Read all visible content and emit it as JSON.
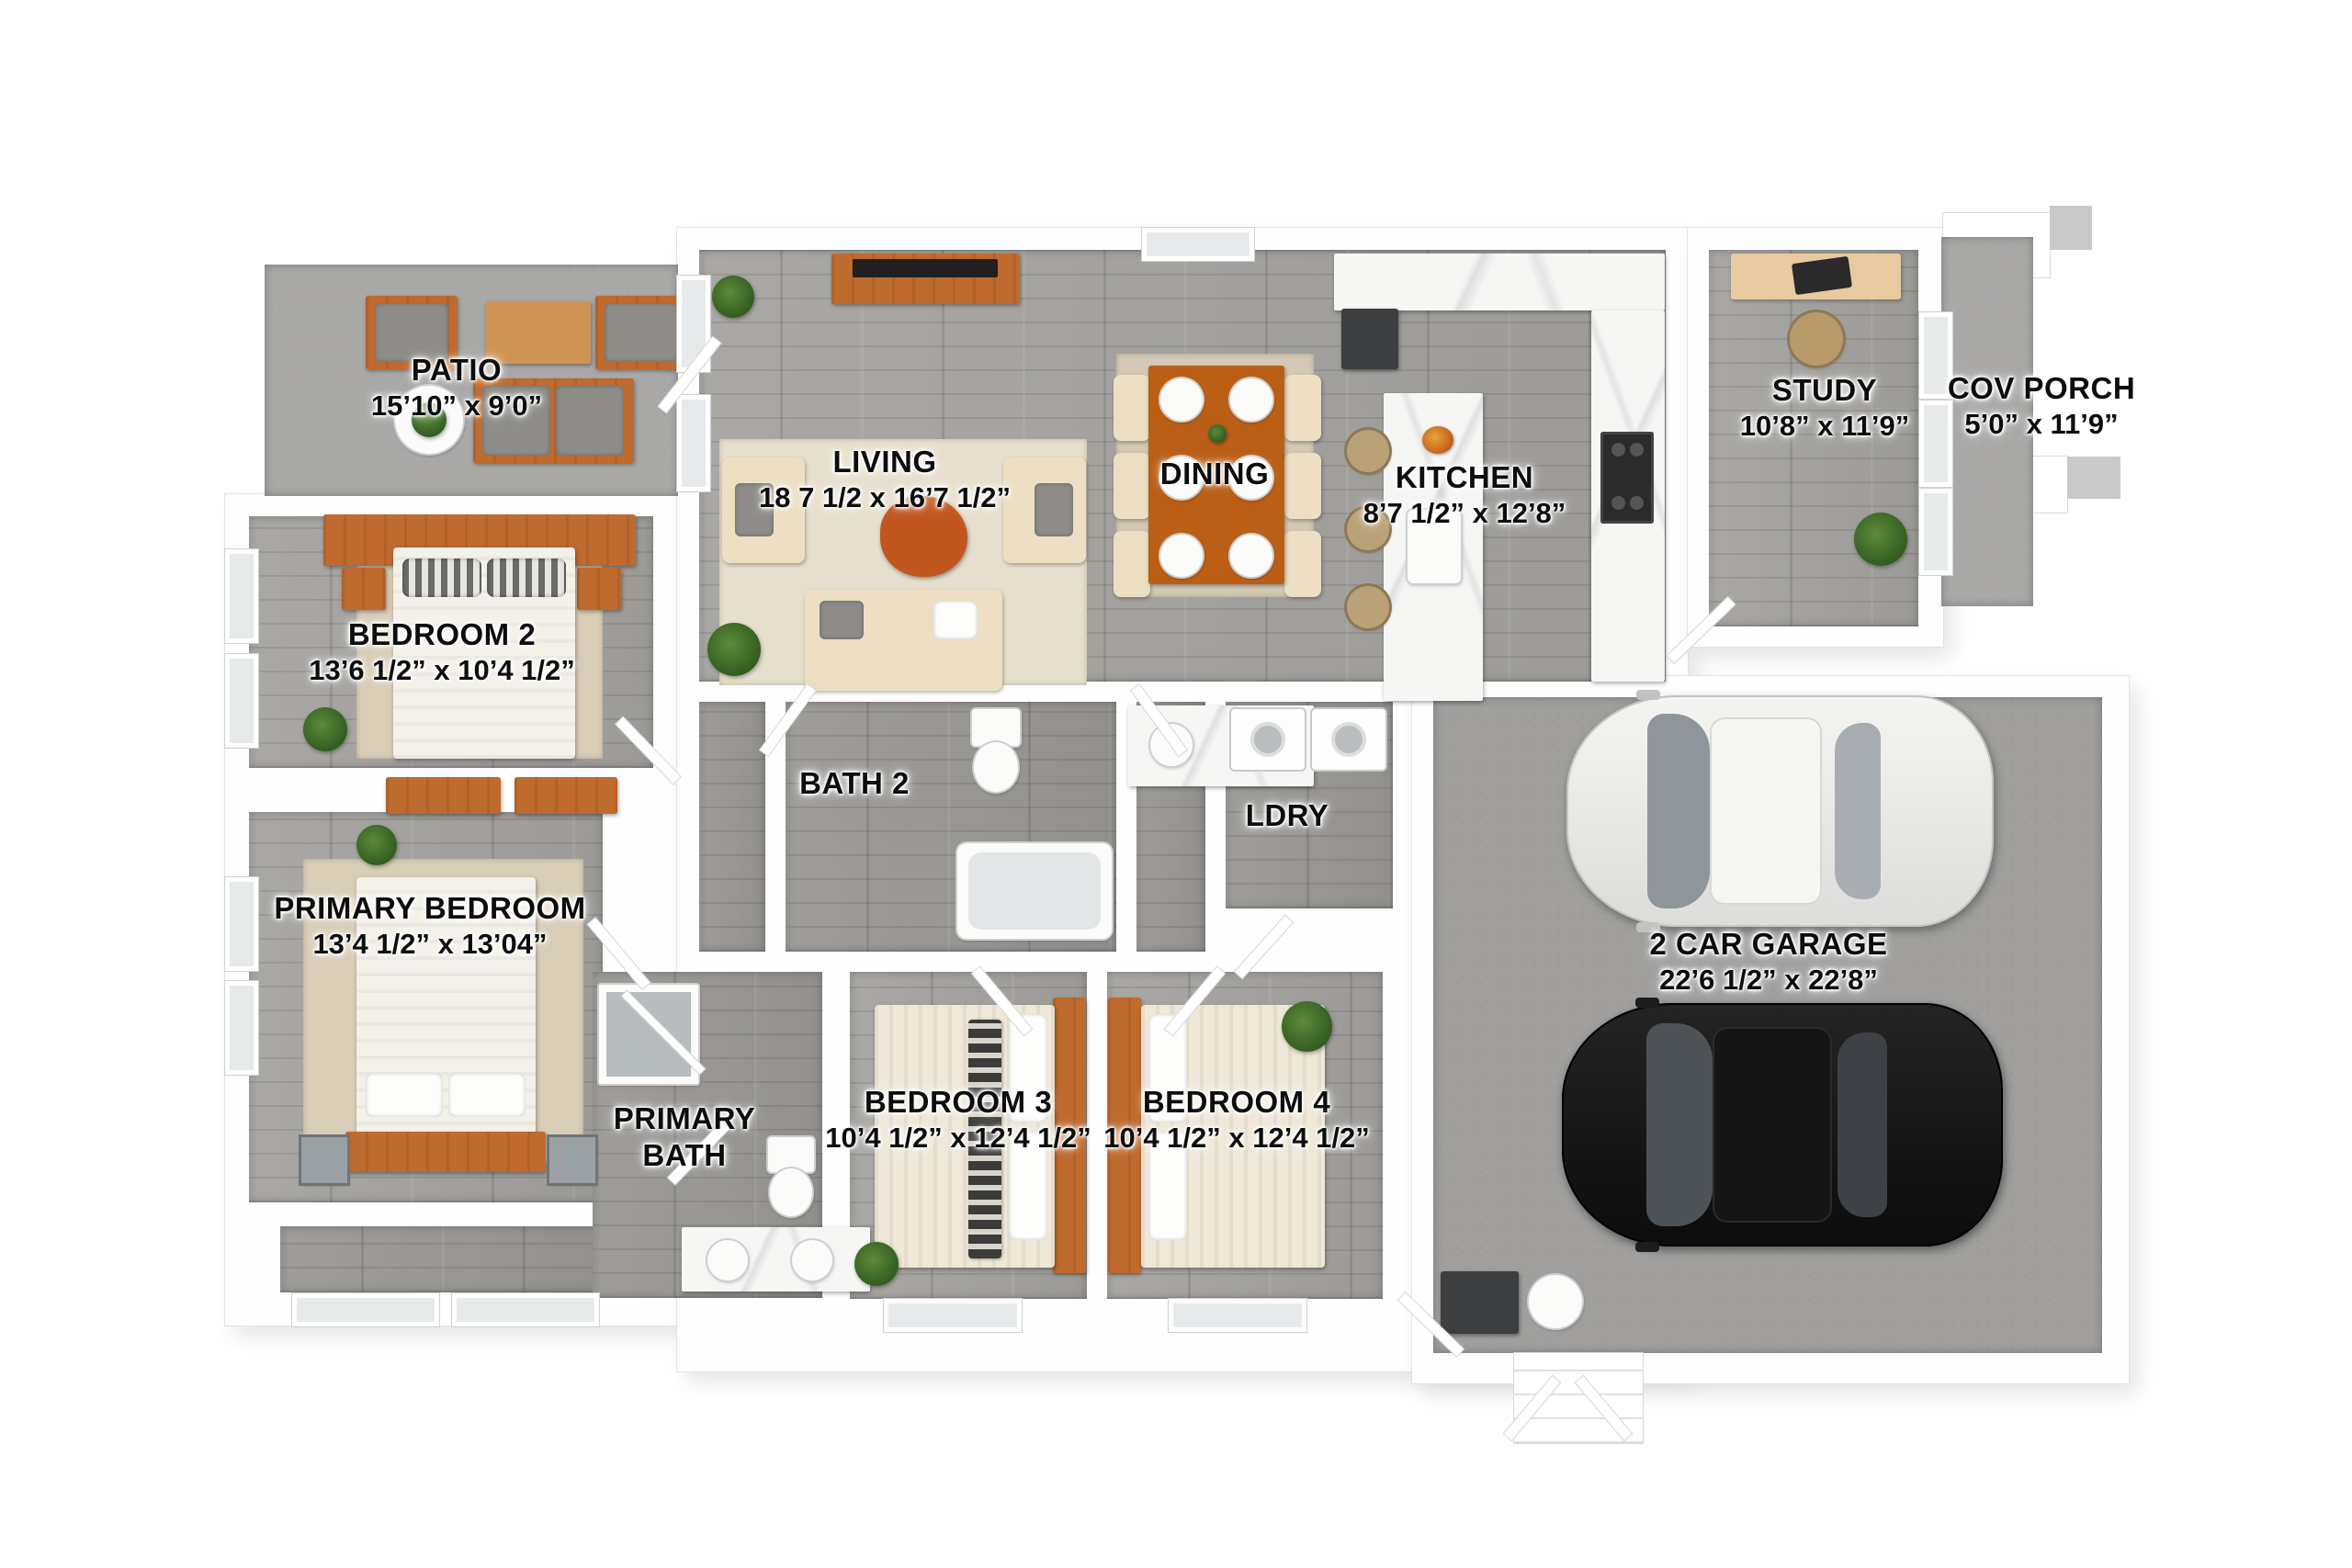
{
  "rooms": {
    "patio": {
      "name": "PATIO",
      "dims": "15’10” x 9’0”"
    },
    "living": {
      "name": "LIVING",
      "dims": "18 7 1/2 x 16’7 1/2”"
    },
    "dining": {
      "name": "DINING",
      "dims": ""
    },
    "kitchen": {
      "name": "KITCHEN",
      "dims": "8’7 1/2” x 12’8”"
    },
    "study": {
      "name": "STUDY",
      "dims": "10’8” x 11’9”"
    },
    "cov_porch": {
      "name": "COV PORCH",
      "dims": "5’0” x 11’9”"
    },
    "bedroom2": {
      "name": "BEDROOM 2",
      "dims": "13’6 1/2” x 10’4 1/2”"
    },
    "bath2": {
      "name": "BATH 2",
      "dims": ""
    },
    "ldry": {
      "name": "LDRY",
      "dims": ""
    },
    "primary_bedroom": {
      "name": "PRIMARY BEDROOM",
      "dims": "13’4 1/2” x 13’04”"
    },
    "primary_bath": {
      "name": "PRIMARY BATH",
      "dims": ""
    },
    "bedroom3": {
      "name": "BEDROOM 3",
      "dims": "10’4 1/2” x 12’4 1/2”"
    },
    "bedroom4": {
      "name": "BEDROOM 4",
      "dims": "10’4 1/2” x 12’4 1/2”"
    },
    "garage": {
      "name": "2 CAR GARAGE",
      "dims": "22’6 1/2” x 22’8”"
    }
  },
  "colors": {
    "wood_furniture_accent": "#bf6a2e",
    "floor_wood_gray": "#a5a3a0",
    "concrete_gray": "#a9a8a6",
    "upholstery_cream": "#ecdfc3",
    "label_text": "#0d0d0d"
  }
}
